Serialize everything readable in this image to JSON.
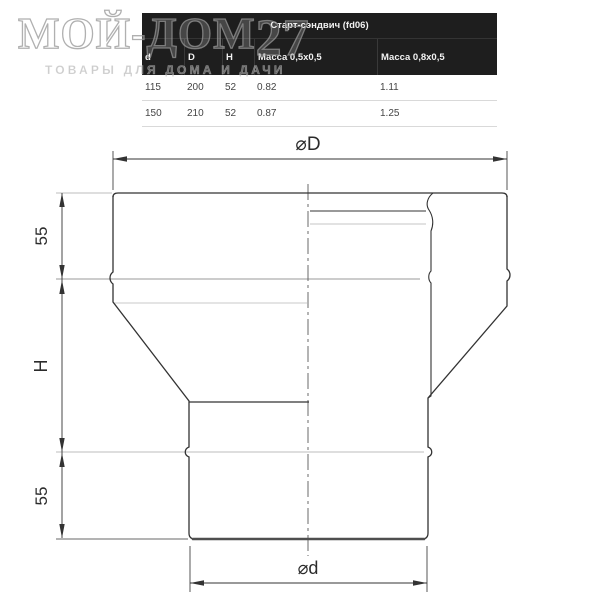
{
  "watermark": {
    "brand_prefix": "МОЙ-ДОМ",
    "brand_suffix": "27",
    "tagline": "ТОВАРЫ ДЛЯ ДОМА И ДАЧИ"
  },
  "table": {
    "title": "Старт-сэндвич (fd06)",
    "columns": [
      "d",
      "D",
      "H",
      "Масса 0,5x0,5",
      "Масса 0,8x0,5"
    ],
    "rows": [
      [
        "115",
        "200",
        "52",
        "0.82",
        "1.11"
      ],
      [
        "150",
        "210",
        "52",
        "0.87",
        "1.25"
      ]
    ]
  },
  "drawing": {
    "dim_top": "⌀D",
    "dim_bottom": "⌀d",
    "seg_top": "55",
    "seg_mid": "H",
    "seg_bottom": "55"
  },
  "colors": {
    "table_header_bg": "#1e1e1e",
    "table_header_text": "#f2f2f2",
    "table_body_text": "#454545",
    "row_border": "#d9d9d9",
    "line_dark": "#333333",
    "line_mid": "#9a9a9a",
    "line_light": "#c6c6c6",
    "watermark_gray": "#969696"
  }
}
